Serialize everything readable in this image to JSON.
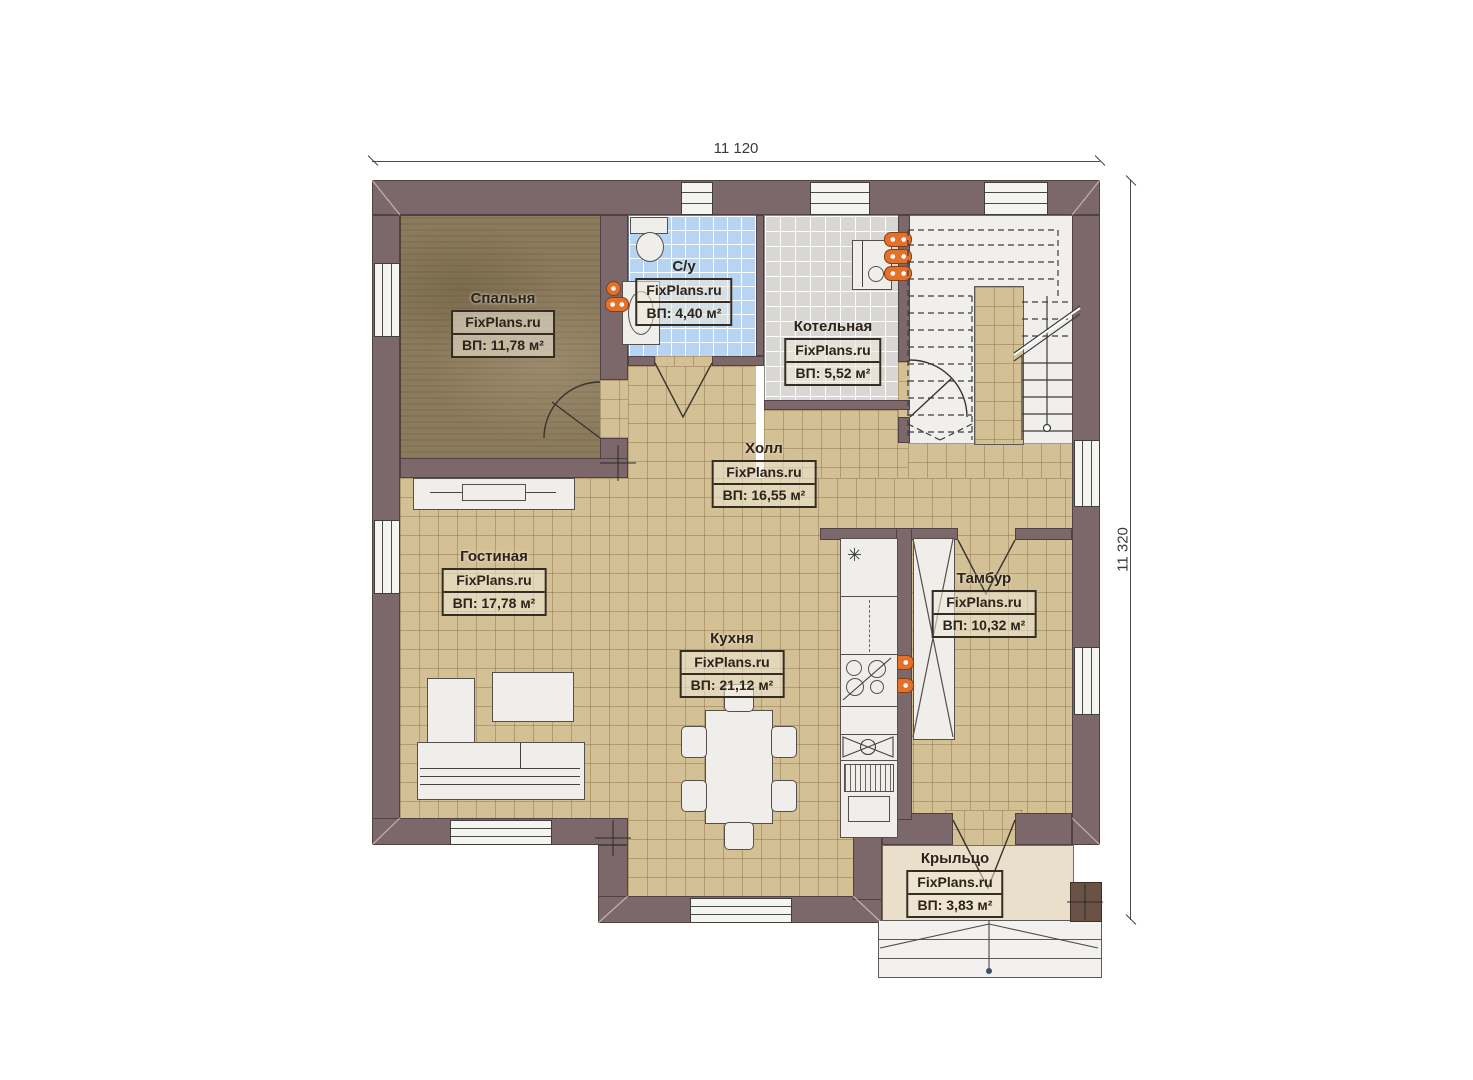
{
  "plan": {
    "type": "floor-plan",
    "language": "ru",
    "watermark": "FixPlans.ru"
  },
  "dimensions": {
    "width_label": "11 120",
    "height_label": "11 320"
  },
  "rooms": [
    {
      "id": "bedroom",
      "name": "Спальня",
      "watermark": "FixPlans.ru",
      "area": "ВП: 11,78 м²"
    },
    {
      "id": "bathroom",
      "name": "С/у",
      "watermark": "FixPlans.ru",
      "area": "ВП: 4,40 м²"
    },
    {
      "id": "boiler",
      "name": "Котельная",
      "watermark": "FixPlans.ru",
      "area": "ВП: 5,52 м²"
    },
    {
      "id": "hall",
      "name": "Холл",
      "watermark": "FixPlans.ru",
      "area": "ВП: 16,55 м²"
    },
    {
      "id": "living",
      "name": "Гостиная",
      "watermark": "FixPlans.ru",
      "area": "ВП: 17,78 м²"
    },
    {
      "id": "kitchen",
      "name": "Кухня",
      "watermark": "FixPlans.ru",
      "area": "ВП: 21,12 м²"
    },
    {
      "id": "tambour",
      "name": "Тамбур",
      "watermark": "FixPlans.ru",
      "area": "ВП: 10,32 м²"
    },
    {
      "id": "porch",
      "name": "Крыльцо",
      "watermark": "FixPlans.ru",
      "area": "ВП: 3,83 м²"
    }
  ],
  "icons": {
    "freezer_symbol": "✳"
  },
  "colors": {
    "wall": "#7c686b",
    "floor_tile_tan": "#d3c095",
    "floor_bathroom_blue": "#b7d5f2",
    "floor_boiler_gray": "#d8d7d4",
    "floor_bedroom_brown": "#8b7a5b",
    "floor_porch_beige": "#e9dfca",
    "fixture_white": "#efeeea",
    "radiator_orange": "#e4712b"
  }
}
